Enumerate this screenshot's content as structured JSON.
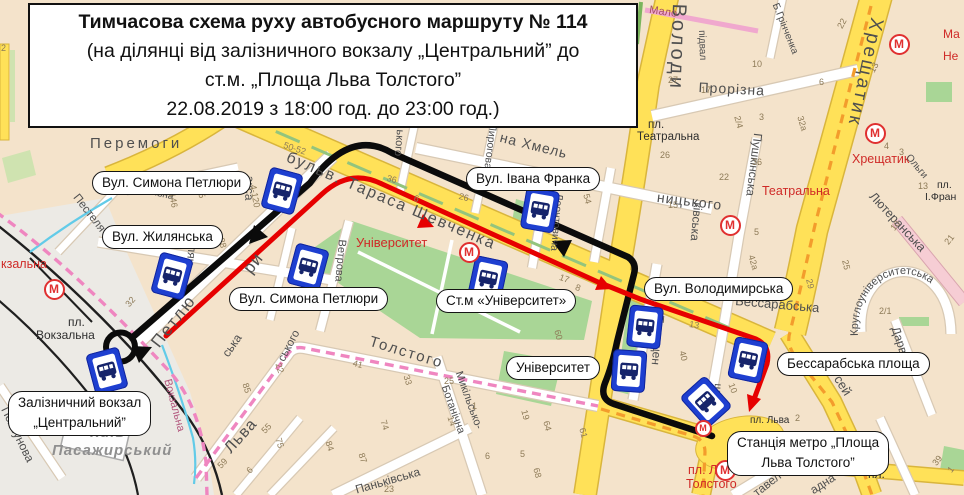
{
  "title": {
    "lines": [
      "Тимчасова схема руху автобусного маршруту  № 114",
      "(на ділянці від залізничного вокзалу „Центральний” до",
      "ст.м. „Площа Льва Толстого”",
      "22.08.2019 з 18:00 год. до 23:00 год.)"
    ]
  },
  "map": {
    "metro_letter": "М",
    "curved_label": "Круглоуніверситетська",
    "colors": {
      "route_arrival_black": "#0b0b0b",
      "route_departure_red": "#e60000",
      "major_road_yellow": "#ffe158",
      "park_green": "#a9d696",
      "metro_red": "#e03030",
      "bus_stop_blue": "#1e3fd0"
    },
    "callouts": [
      {
        "lines": [
          "Вул. Симона Петлюри"
        ],
        "x": 92,
        "y": 171
      },
      {
        "lines": [
          "Вул. Жилянська"
        ],
        "x": 102,
        "y": 225
      },
      {
        "lines": [
          "Вул. Івана Франка"
        ],
        "x": 466,
        "y": 167
      },
      {
        "lines": [
          "Вул. Симона Петлюри"
        ],
        "x": 229,
        "y": 287
      },
      {
        "lines": [
          "Ст.м «Університет»"
        ],
        "x": 436,
        "y": 289
      },
      {
        "lines": [
          "Вул. Володимирська"
        ],
        "x": 644,
        "y": 277
      },
      {
        "lines": [
          "Університет"
        ],
        "x": 506,
        "y": 356
      },
      {
        "lines": [
          "Бессарабська площа"
        ],
        "x": 777,
        "y": 352
      },
      {
        "lines": [
          "Залізничний вокзал",
          "„Центральний”"
        ],
        "x": 8,
        "y": 391
      },
      {
        "lines": [
          "Станція метро „Площа",
          "Льва Толстого”"
        ],
        "x": 727,
        "y": 431
      }
    ],
    "street_labels": [
      {
        "t": "Перемоги",
        "x": 90,
        "y": 136,
        "r": 0,
        "s": 15,
        "c": "gray",
        "ls": 3
      },
      {
        "t": "бульв. Тараса Шевченка",
        "x": 290,
        "y": 150,
        "r": 23,
        "s": 16,
        "c": "gray",
        "ls": 2
      },
      {
        "t": "Володи",
        "x": 689,
        "y": 4,
        "r": 92,
        "s": 20,
        "c": "gray",
        "ls": 3
      },
      {
        "t": "підвал",
        "x": 706,
        "y": 30,
        "r": 88,
        "s": 10,
        "c": "gray"
      },
      {
        "t": "Мало",
        "x": 650,
        "y": 5,
        "r": 8,
        "s": 11,
        "c": "maroon"
      },
      {
        "t": "Прорізна",
        "x": 699,
        "y": 80,
        "r": 3,
        "s": 14,
        "c": "gray",
        "ls": 1
      },
      {
        "t": "Б.Грінченка",
        "x": 779,
        "y": 2,
        "r": 68,
        "s": 10,
        "c": "gray"
      },
      {
        "t": "Хрещатик",
        "x": 886,
        "y": 20,
        "r": 102,
        "s": 19,
        "c": "gray",
        "ls": 3
      },
      {
        "t": "пл.",
        "x": 648,
        "y": 119,
        "r": 0,
        "s": 11.5,
        "c": "dark"
      },
      {
        "t": "Театральна",
        "x": 637,
        "y": 131,
        "r": 0,
        "s": 11.5,
        "c": "dark"
      },
      {
        "t": "Театральна",
        "x": 762,
        "y": 185,
        "r": 0,
        "s": 12.5,
        "c": "red"
      },
      {
        "t": "Хрещатик",
        "x": 852,
        "y": 153,
        "r": 0,
        "s": 12.5,
        "c": "red"
      },
      {
        "t": "Ма",
        "x": 943,
        "y": 28,
        "r": 0,
        "s": 12,
        "c": "red"
      },
      {
        "t": "Не",
        "x": 943,
        "y": 50,
        "r": 0,
        "s": 12,
        "c": "red"
      },
      {
        "t": "на Хмель",
        "x": 502,
        "y": 130,
        "r": 14,
        "s": 14,
        "c": "gray",
        "ls": 1
      },
      {
        "t": "ницького",
        "x": 658,
        "y": 190,
        "r": 7,
        "s": 14,
        "c": "gray",
        "ls": 1
      },
      {
        "t": "ького",
        "x": 405,
        "y": 130,
        "r": 95,
        "s": 11,
        "c": "gray"
      },
      {
        "t": "Пирогова",
        "x": 498,
        "y": 124,
        "r": 97,
        "s": 10.5,
        "c": "gray"
      },
      {
        "t": "Леонтовича",
        "x": 564,
        "y": 194,
        "r": 95,
        "s": 10.5,
        "c": "gray"
      },
      {
        "t": "Пушкінська",
        "x": 764,
        "y": 134,
        "r": 97,
        "s": 12,
        "c": "gray"
      },
      {
        "t": "ківська",
        "x": 704,
        "y": 203,
        "r": 95,
        "s": 12,
        "c": "gray"
      },
      {
        "t": "Лютеранська",
        "x": 876,
        "y": 190,
        "r": 47,
        "s": 12.5,
        "c": "gray"
      },
      {
        "t": "Ольги",
        "x": 911,
        "y": 153,
        "r": 50,
        "s": 10,
        "c": "gray"
      },
      {
        "t": "пл.",
        "x": 937,
        "y": 180,
        "r": 0,
        "s": 10.5,
        "c": "dark"
      },
      {
        "t": "І.Фран",
        "x": 925,
        "y": 192,
        "r": 0,
        "s": 10.5,
        "c": "dark"
      },
      {
        "t": "Університет",
        "x": 356,
        "y": 236,
        "r": 0,
        "s": 13,
        "c": "red"
      },
      {
        "t": "Бессарабська",
        "x": 736,
        "y": 294,
        "r": 5,
        "s": 13,
        "c": "gray"
      },
      {
        "t": "Дарвіна",
        "x": 901,
        "y": 325,
        "r": 72,
        "s": 12,
        "c": "gray"
      },
      {
        "t": "сей",
        "x": 843,
        "y": 373,
        "r": 58,
        "s": 13,
        "c": "gray"
      },
      {
        "t": "тавел",
        "x": 751,
        "y": 489,
        "r": -38,
        "s": 12,
        "c": "gray"
      },
      {
        "t": "адна",
        "x": 808,
        "y": 486,
        "r": -33,
        "s": 12,
        "c": "gray"
      },
      {
        "t": "пл.",
        "x": 868,
        "y": 468,
        "r": 0,
        "s": 12,
        "c": "dark"
      },
      {
        "t": "пл. Льва",
        "x": 750,
        "y": 416,
        "r": 0,
        "s": 10,
        "c": "dark"
      },
      {
        "t": "пл. Льва",
        "x": 688,
        "y": 464,
        "r": 0,
        "s": 12.5,
        "c": "red"
      },
      {
        "t": "Толстого",
        "x": 686,
        "y": 478,
        "r": 0,
        "s": 12.5,
        "c": "red"
      },
      {
        "t": "Терещен",
        "x": 666,
        "y": 316,
        "r": 95,
        "s": 12,
        "c": "gray"
      },
      {
        "t": "шкін",
        "x": 723,
        "y": 384,
        "r": 95,
        "s": 11,
        "c": "gray"
      },
      {
        "t": "Толстого",
        "x": 372,
        "y": 334,
        "r": 17,
        "s": 15,
        "c": "gray",
        "ls": 2
      },
      {
        "t": "Льва",
        "x": 222,
        "y": 446,
        "r": -48,
        "s": 16,
        "c": "gray",
        "ls": 1
      },
      {
        "t": "Микільсько-",
        "x": 463,
        "y": 370,
        "r": 70,
        "s": 11,
        "c": "gray"
      },
      {
        "t": "Ботанічна",
        "x": 449,
        "y": 384,
        "r": 70,
        "s": 11,
        "c": "gray"
      },
      {
        "t": "Паньківська",
        "x": 354,
        "y": 484,
        "r": -16,
        "s": 12,
        "c": "gray"
      },
      {
        "t": "Ветрова",
        "x": 347,
        "y": 240,
        "r": 95,
        "s": 11,
        "c": "gray"
      },
      {
        "t": "ського",
        "x": 276,
        "y": 358,
        "r": -62,
        "s": 11.5,
        "c": "gray"
      },
      {
        "t": "ська",
        "x": 220,
        "y": 352,
        "r": -55,
        "s": 12,
        "c": "gray"
      },
      {
        "t": "Петлю",
        "x": 148,
        "y": 340,
        "r": -52,
        "s": 17,
        "c": "gray",
        "ls": 2
      },
      {
        "t": "ри",
        "x": 240,
        "y": 266,
        "r": -52,
        "s": 17,
        "c": "gray",
        "ls": 1
      },
      {
        "t": "акса",
        "x": 256,
        "y": 176,
        "r": 92,
        "s": 12,
        "c": "gray"
      },
      {
        "t": "Жилян",
        "x": 200,
        "y": 228,
        "r": 95,
        "s": 12,
        "c": "gray"
      },
      {
        "t": "вокзальна",
        "x": 128,
        "y": 182,
        "r": 13,
        "s": 10,
        "c": "gray"
      },
      {
        "t": "Пестеля",
        "x": 80,
        "y": 192,
        "r": 52,
        "s": 11.5,
        "c": "gray"
      },
      {
        "t": "пл.",
        "x": 68,
        "y": 316,
        "r": 0,
        "s": 12,
        "c": "dark"
      },
      {
        "t": "Вокзальна",
        "x": 36,
        "y": 329,
        "r": 0,
        "s": 12,
        "c": "dark"
      },
      {
        "t": "кзальна",
        "x": 1,
        "y": 258,
        "r": 0,
        "s": 12.5,
        "c": "red"
      },
      {
        "t": "Вокзальна",
        "x": 172,
        "y": 378,
        "r": 75,
        "s": 11,
        "c": "pink"
      },
      {
        "t": "Київ-",
        "x": 90,
        "y": 425,
        "r": 0,
        "s": 15,
        "c": "kyiv"
      },
      {
        "t": "Пасажирський",
        "x": 52,
        "y": 443,
        "r": 0,
        "s": 15,
        "c": "kyiv"
      },
      {
        "t": "Ползунова",
        "x": 10,
        "y": 405,
        "r": 64,
        "s": 12,
        "c": "gray"
      }
    ],
    "numbers": [
      {
        "t": "2",
        "x": 1,
        "y": 44,
        "r": 0
      },
      {
        "t": "50-52",
        "x": 285,
        "y": 141,
        "r": 18
      },
      {
        "t": "36",
        "x": 388,
        "y": 174,
        "r": 15
      },
      {
        "t": "6",
        "x": 415,
        "y": 194,
        "r": 15
      },
      {
        "t": "26",
        "x": 460,
        "y": 192,
        "r": 15
      },
      {
        "t": "146",
        "x": 176,
        "y": 192,
        "r": 80
      },
      {
        "t": "47/5",
        "x": 201,
        "y": 180,
        "r": 72
      },
      {
        "t": "4-120",
        "x": 257,
        "y": 184,
        "r": 80
      },
      {
        "t": "28",
        "x": 225,
        "y": 237,
        "r": 75
      },
      {
        "t": "27",
        "x": 668,
        "y": 76,
        "r": 0
      },
      {
        "t": "17",
        "x": 701,
        "y": 86,
        "r": 0
      },
      {
        "t": "10",
        "x": 752,
        "y": 60,
        "r": 0
      },
      {
        "t": "6",
        "x": 819,
        "y": 78,
        "r": 0
      },
      {
        "t": "22",
        "x": 836,
        "y": 26,
        "r": -62
      },
      {
        "t": "13",
        "x": 868,
        "y": 70,
        "r": -62
      },
      {
        "t": "2/4",
        "x": 741,
        "y": 115,
        "r": 75
      },
      {
        "t": "3",
        "x": 759,
        "y": 113,
        "r": 0
      },
      {
        "t": "32а",
        "x": 804,
        "y": 115,
        "r": 73
      },
      {
        "t": "26",
        "x": 660,
        "y": 151,
        "r": 0
      },
      {
        "t": "22",
        "x": 719,
        "y": 173,
        "r": 0
      },
      {
        "t": "36",
        "x": 752,
        "y": 158,
        "r": 0
      },
      {
        "t": "15",
        "x": 668,
        "y": 201,
        "r": 0
      },
      {
        "t": "5",
        "x": 754,
        "y": 228,
        "r": 0
      },
      {
        "t": "42а",
        "x": 755,
        "y": 254,
        "r": 73
      },
      {
        "t": "54",
        "x": 590,
        "y": 193,
        "r": 75
      },
      {
        "t": "4",
        "x": 884,
        "y": 142,
        "r": 0
      },
      {
        "t": "3",
        "x": 899,
        "y": 148,
        "r": 0
      },
      {
        "t": "13",
        "x": 918,
        "y": 182,
        "r": 0
      },
      {
        "t": "10",
        "x": 889,
        "y": 227,
        "r": -52
      },
      {
        "t": "21",
        "x": 943,
        "y": 241,
        "r": -52
      },
      {
        "t": "25",
        "x": 849,
        "y": 259,
        "r": 78
      },
      {
        "t": "29",
        "x": 813,
        "y": 278,
        "r": 78
      },
      {
        "t": "2/1",
        "x": 879,
        "y": 307,
        "r": 0
      },
      {
        "t": "17",
        "x": 561,
        "y": 273,
        "r": 20
      },
      {
        "t": "8",
        "x": 577,
        "y": 283,
        "r": 20
      },
      {
        "t": "60",
        "x": 561,
        "y": 329,
        "r": 75
      },
      {
        "t": "13",
        "x": 690,
        "y": 320,
        "r": 10
      },
      {
        "t": "40",
        "x": 686,
        "y": 350,
        "r": 75
      },
      {
        "t": "10",
        "x": 735,
        "y": 382,
        "r": 70
      },
      {
        "t": "32",
        "x": 124,
        "y": 303,
        "r": -50
      },
      {
        "t": "22",
        "x": 282,
        "y": 362,
        "r": 72
      },
      {
        "t": "85",
        "x": 249,
        "y": 382,
        "r": 72
      },
      {
        "t": "55",
        "x": 260,
        "y": 429,
        "r": -45
      },
      {
        "t": "75",
        "x": 282,
        "y": 437,
        "r": 72
      },
      {
        "t": "59",
        "x": 216,
        "y": 464,
        "r": -45
      },
      {
        "t": "6",
        "x": 245,
        "y": 469,
        "r": -45
      },
      {
        "t": "61",
        "x": 586,
        "y": 427,
        "r": 75
      },
      {
        "t": "64",
        "x": 550,
        "y": 420,
        "r": 75
      },
      {
        "t": "19",
        "x": 528,
        "y": 409,
        "r": 75
      },
      {
        "t": "68",
        "x": 540,
        "y": 467,
        "r": 75
      },
      {
        "t": "5",
        "x": 520,
        "y": 450,
        "r": 0
      },
      {
        "t": "6",
        "x": 485,
        "y": 452,
        "r": 0
      },
      {
        "t": "14",
        "x": 454,
        "y": 415,
        "r": 72
      },
      {
        "t": "1",
        "x": 472,
        "y": 402,
        "r": 0
      },
      {
        "t": "25",
        "x": 444,
        "y": 377,
        "r": 0
      },
      {
        "t": "33",
        "x": 410,
        "y": 374,
        "r": 72
      },
      {
        "t": "41",
        "x": 354,
        "y": 359,
        "r": 15
      },
      {
        "t": "74",
        "x": 387,
        "y": 419,
        "r": 72
      },
      {
        "t": "84",
        "x": 332,
        "y": 440,
        "r": 72
      },
      {
        "t": "87",
        "x": 365,
        "y": 452,
        "r": 72
      },
      {
        "t": "23",
        "x": 384,
        "y": 485,
        "r": 0
      },
      {
        "t": "39",
        "x": 931,
        "y": 462,
        "r": -52
      },
      {
        "t": "1",
        "x": 946,
        "y": 469,
        "r": -52
      },
      {
        "t": "2",
        "x": 795,
        "y": 414,
        "r": 0
      }
    ],
    "bus_stops": [
      {
        "x": 282,
        "y": 191,
        "r": 15
      },
      {
        "x": 172,
        "y": 276,
        "r": 15
      },
      {
        "x": 308,
        "y": 267,
        "r": 15
      },
      {
        "x": 107,
        "y": 371,
        "r": -15
      },
      {
        "x": 488,
        "y": 279,
        "r": 12
      },
      {
        "x": 540,
        "y": 210,
        "r": 10
      },
      {
        "x": 645,
        "y": 327,
        "r": 6
      },
      {
        "x": 629,
        "y": 371,
        "r": 4
      },
      {
        "x": 748,
        "y": 360,
        "r": 12
      },
      {
        "x": 706,
        "y": 402,
        "r": -42
      }
    ],
    "metro_stations": [
      {
        "x": 54,
        "y": 289,
        "s": 17
      },
      {
        "x": 469,
        "y": 252,
        "s": 17
      },
      {
        "x": 730,
        "y": 225,
        "s": 17
      },
      {
        "x": 875,
        "y": 133,
        "s": 17
      },
      {
        "x": 899,
        "y": 44,
        "s": 17
      },
      {
        "x": 725,
        "y": 470,
        "s": 17
      },
      {
        "x": 703,
        "y": 428,
        "s": 13
      }
    ]
  }
}
